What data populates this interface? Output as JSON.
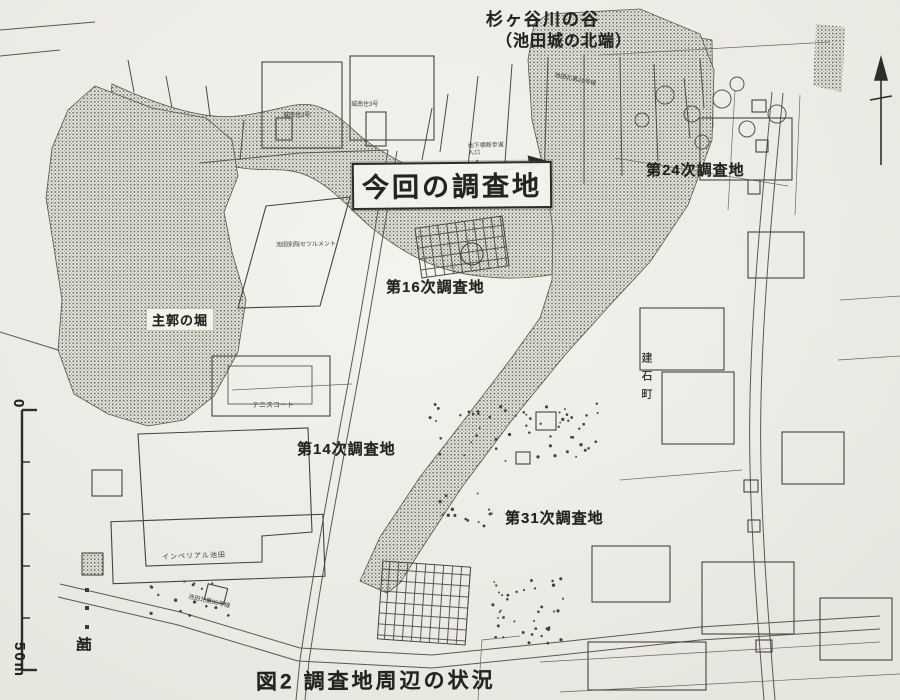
{
  "figure": {
    "caption": "図2 調査地周辺の状況"
  },
  "map": {
    "valley": {
      "line1": "杉ヶ谷川の谷",
      "line2": "（池田城の北端）"
    },
    "current_site": {
      "label": "今回の調査地",
      "note_line1": "地下横断歩道",
      "note_line2": "入口"
    },
    "survey_sites": [
      {
        "label": "第24次調査地"
      },
      {
        "label": "第16次調査地"
      },
      {
        "label": "第14次調査地"
      },
      {
        "label": "第31次調査地"
      }
    ],
    "places": {
      "moat": "主郭の堀",
      "tennis": "テニスコート",
      "settlement": "池田別院セツルメント",
      "imperial": "インペリアル池田",
      "housing2": "城南住2号",
      "housing3": "城南住3号",
      "town": "建石町",
      "road21": "池田北第21号線",
      "road35": "池田北第35号線"
    },
    "legend": {
      "moat_label": "堀"
    },
    "scale": {
      "top": "0",
      "bottom": "50m"
    },
    "ink": "#3b3a34",
    "stipple": "#6d6b62"
  }
}
